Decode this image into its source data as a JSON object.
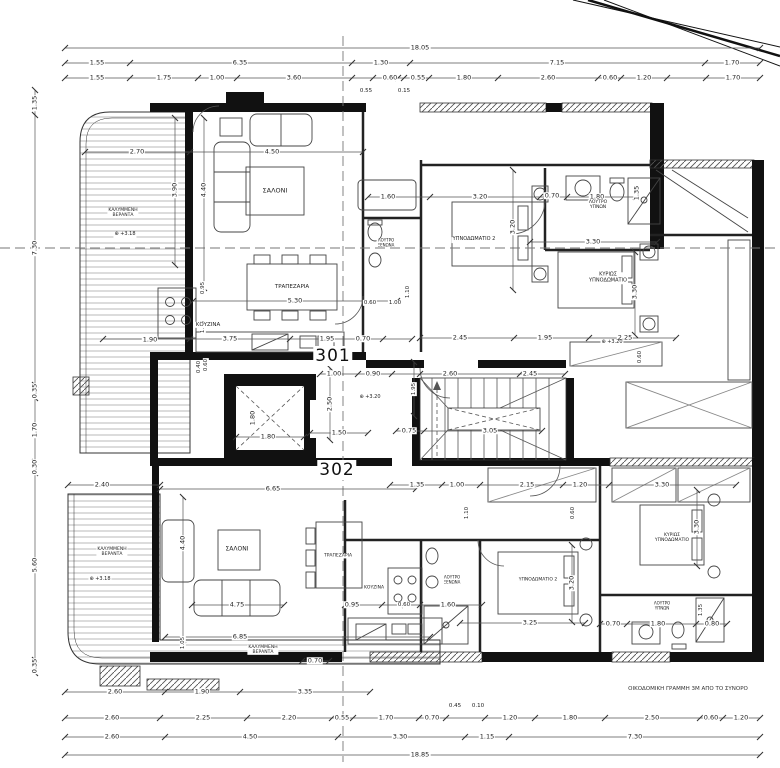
{
  "plan": {
    "apartments": [
      {
        "number": "301"
      },
      {
        "number": "302"
      }
    ],
    "note": "ΟΙΚΟΔΟΜΙΚΗ ΓΡΑΜΜΗ 3Μ ΑΠΟ ΤΟ ΣΥΝΟΡΟ",
    "overall_width_top": "18.05",
    "overall_width_bottom": "18.85",
    "levels": [
      "+3.20",
      "+3.18"
    ],
    "elevator_size": "1.80 x 1.80"
  },
  "labels": [
    {
      "name": "dim-label",
      "text": "18.05",
      "x": 420,
      "y": 48
    },
    {
      "name": "dim-label",
      "text": "1.55",
      "x": 97,
      "y": 63
    },
    {
      "name": "dim-label",
      "text": "6.35",
      "x": 240,
      "y": 63
    },
    {
      "name": "dim-label",
      "text": "1.30",
      "x": 381,
      "y": 63
    },
    {
      "name": "dim-label",
      "text": "7.15",
      "x": 557,
      "y": 63
    },
    {
      "name": "dim-label",
      "text": "1.70",
      "x": 732,
      "y": 63
    },
    {
      "name": "dim-label",
      "text": "1.55",
      "x": 97,
      "y": 78
    },
    {
      "name": "dim-label",
      "text": "1.75",
      "x": 164,
      "y": 78
    },
    {
      "name": "dim-label",
      "text": "1.00",
      "x": 217,
      "y": 78
    },
    {
      "name": "dim-label",
      "text": "3.60",
      "x": 294,
      "y": 78
    },
    {
      "name": "dim-label",
      "text": "0.60",
      "x": 390,
      "y": 78
    },
    {
      "name": "dim-label",
      "text": "0.55",
      "x": 418,
      "y": 78
    },
    {
      "name": "dim-label",
      "text": "1.80",
      "x": 464,
      "y": 78
    },
    {
      "name": "dim-label",
      "text": "2.60",
      "x": 548,
      "y": 78
    },
    {
      "name": "dim-label",
      "text": "0.60",
      "x": 610,
      "y": 78
    },
    {
      "name": "dim-label",
      "text": "1.20",
      "x": 644,
      "y": 78
    },
    {
      "name": "dim-label",
      "text": "1.70",
      "x": 733,
      "y": 78
    },
    {
      "name": "dim-label",
      "text": "0.55",
      "x": 366,
      "y": 91,
      "s": 5.5
    },
    {
      "name": "dim-label",
      "text": "0.15",
      "x": 404,
      "y": 91,
      "s": 5.5
    },
    {
      "name": "dim-label",
      "text": "1.35",
      "x": 35,
      "y": 103,
      "rot": true
    },
    {
      "name": "dim-label",
      "text": "7.30",
      "x": 35,
      "y": 248,
      "rot": true
    },
    {
      "name": "dim-label",
      "text": "0.35",
      "x": 35,
      "y": 391,
      "rot": true
    },
    {
      "name": "dim-label",
      "text": "1.70",
      "x": 35,
      "y": 430,
      "rot": true
    },
    {
      "name": "dim-label",
      "text": "0.30",
      "x": 35,
      "y": 467,
      "rot": true
    },
    {
      "name": "dim-label",
      "text": "5.60",
      "x": 35,
      "y": 565,
      "rot": true
    },
    {
      "name": "dim-label",
      "text": "0.35",
      "x": 35,
      "y": 666,
      "rot": true
    },
    {
      "name": "dim-label",
      "text": "2.60",
      "x": 115,
      "y": 692
    },
    {
      "name": "dim-label",
      "text": "1.90",
      "x": 202,
      "y": 692
    },
    {
      "name": "dim-label",
      "text": "3.35",
      "x": 305,
      "y": 692
    },
    {
      "name": "dim-label",
      "text": "2.60",
      "x": 112,
      "y": 718
    },
    {
      "name": "dim-label",
      "text": "2.25",
      "x": 203,
      "y": 718
    },
    {
      "name": "dim-label",
      "text": "2.20",
      "x": 289,
      "y": 718
    },
    {
      "name": "dim-label",
      "text": "0.55",
      "x": 342,
      "y": 718
    },
    {
      "name": "dim-label",
      "text": "1.70",
      "x": 386,
      "y": 718
    },
    {
      "name": "dim-label",
      "text": "0.70",
      "x": 432,
      "y": 718
    },
    {
      "name": "dim-label",
      "text": "0.45",
      "x": 455,
      "y": 706,
      "s": 5.5
    },
    {
      "name": "dim-label",
      "text": "0.10",
      "x": 478,
      "y": 706,
      "s": 5.5
    },
    {
      "name": "dim-label",
      "text": "1.20",
      "x": 510,
      "y": 718
    },
    {
      "name": "dim-label",
      "text": "1.80",
      "x": 570,
      "y": 718
    },
    {
      "name": "dim-label",
      "text": "2.50",
      "x": 652,
      "y": 718
    },
    {
      "name": "dim-label",
      "text": "0.60",
      "x": 711,
      "y": 718
    },
    {
      "name": "dim-label",
      "text": "1.20",
      "x": 741,
      "y": 718
    },
    {
      "name": "dim-label",
      "text": "2.60",
      "x": 112,
      "y": 737
    },
    {
      "name": "dim-label",
      "text": "4.50",
      "x": 250,
      "y": 737
    },
    {
      "name": "dim-label",
      "text": "3.30",
      "x": 400,
      "y": 737
    },
    {
      "name": "dim-label",
      "text": "1.15",
      "x": 487,
      "y": 737
    },
    {
      "name": "dim-label",
      "text": "7.30",
      "x": 635,
      "y": 737
    },
    {
      "name": "dim-label",
      "text": "18.85",
      "x": 420,
      "y": 755
    },
    {
      "name": "dim-label",
      "text": "2.70",
      "x": 137,
      "y": 152
    },
    {
      "name": "dim-label",
      "text": "4.50",
      "x": 272,
      "y": 152
    },
    {
      "name": "dim-label",
      "text": "3.90",
      "x": 175,
      "y": 190,
      "rot": true
    },
    {
      "name": "dim-label",
      "text": "4.40",
      "x": 204,
      "y": 190,
      "rot": true
    },
    {
      "name": "dim-label",
      "text": "1.90",
      "x": 150,
      "y": 340
    },
    {
      "name": "dim-label",
      "text": "3.75",
      "x": 230,
      "y": 339
    },
    {
      "name": "dim-label",
      "text": "1.95",
      "x": 327,
      "y": 339
    },
    {
      "name": "dim-label",
      "text": "0.70",
      "x": 363,
      "y": 339
    },
    {
      "name": "dim-label",
      "text": "0.95",
      "x": 203,
      "y": 288,
      "rot": true,
      "s": 5.5
    },
    {
      "name": "dim-label",
      "text": "1.35",
      "x": 203,
      "y": 327,
      "rot": true,
      "s": 5.5
    },
    {
      "name": "dim-label",
      "text": "0.60",
      "x": 206,
      "y": 365,
      "rot": true,
      "s": 5.5
    },
    {
      "name": "dim-label",
      "text": "5.30",
      "x": 295,
      "y": 301
    },
    {
      "name": "dim-label",
      "text": "1.00",
      "x": 334,
      "y": 374
    },
    {
      "name": "dim-label",
      "text": "0.90",
      "x": 373,
      "y": 374
    },
    {
      "name": "dim-label",
      "text": "2.60",
      "x": 450,
      "y": 374
    },
    {
      "name": "dim-label",
      "text": "2.45",
      "x": 530,
      "y": 374
    },
    {
      "name": "dim-label",
      "text": "1.60",
      "x": 388,
      "y": 197
    },
    {
      "name": "dim-label",
      "text": "3.20",
      "x": 480,
      "y": 197
    },
    {
      "name": "dim-label",
      "text": "0.70",
      "x": 552,
      "y": 196
    },
    {
      "name": "dim-label",
      "text": "1.80",
      "x": 597,
      "y": 197
    },
    {
      "name": "dim-label",
      "text": "1.35",
      "x": 637,
      "y": 193,
      "rot": true
    },
    {
      "name": "dim-label",
      "text": "3.20",
      "x": 513,
      "y": 227,
      "rot": true
    },
    {
      "name": "dim-label",
      "text": "1.10",
      "x": 408,
      "y": 292,
      "rot": true,
      "s": 5.5
    },
    {
      "name": "dim-label",
      "text": "0.60",
      "x": 370,
      "y": 303,
      "s": 5.5
    },
    {
      "name": "dim-label",
      "text": "1.00",
      "x": 395,
      "y": 303,
      "s": 5.5
    },
    {
      "name": "dim-label",
      "text": "3.30",
      "x": 593,
      "y": 242
    },
    {
      "name": "dim-label",
      "text": "3.30",
      "x": 635,
      "y": 292,
      "rot": true
    },
    {
      "name": "dim-label",
      "text": "2.45",
      "x": 460,
      "y": 338
    },
    {
      "name": "dim-label",
      "text": "1.95",
      "x": 545,
      "y": 338
    },
    {
      "name": "dim-label",
      "text": "2.25",
      "x": 625,
      "y": 338
    },
    {
      "name": "dim-label",
      "text": "0.60",
      "x": 640,
      "y": 357,
      "rot": true,
      "s": 5.5
    },
    {
      "name": "dim-label",
      "text": "0.40",
      "x": 199,
      "y": 367,
      "rot": true,
      "s": 5.5
    },
    {
      "name": "dim-label",
      "text": "1.80",
      "x": 253,
      "y": 418,
      "rot": true
    },
    {
      "name": "dim-label",
      "text": "1.80",
      "x": 268,
      "y": 437
    },
    {
      "name": "dim-label",
      "text": "2.50",
      "x": 330,
      "y": 404,
      "rot": true
    },
    {
      "name": "dim-label",
      "text": "1.50",
      "x": 339,
      "y": 433
    },
    {
      "name": "dim-label",
      "text": "1.95",
      "x": 414,
      "y": 389,
      "rot": true,
      "s": 5.5
    },
    {
      "name": "dim-label",
      "text": "0.75",
      "x": 409,
      "y": 431
    },
    {
      "name": "dim-label",
      "text": "3.05",
      "x": 490,
      "y": 431
    },
    {
      "name": "dim-label",
      "text": "2.40",
      "x": 102,
      "y": 485
    },
    {
      "name": "dim-label",
      "text": "6.65",
      "x": 273,
      "y": 489
    },
    {
      "name": "dim-label",
      "text": "1.35",
      "x": 417,
      "y": 485
    },
    {
      "name": "dim-label",
      "text": "1.00",
      "x": 457,
      "y": 485
    },
    {
      "name": "dim-label",
      "text": "2.15",
      "x": 527,
      "y": 485
    },
    {
      "name": "dim-label",
      "text": "1.20",
      "x": 580,
      "y": 485
    },
    {
      "name": "dim-label",
      "text": "3.30",
      "x": 662,
      "y": 485
    },
    {
      "name": "dim-label",
      "text": "1.10",
      "x": 467,
      "y": 513,
      "rot": true,
      "s": 5.5
    },
    {
      "name": "dim-label",
      "text": "0.60",
      "x": 573,
      "y": 513,
      "rot": true,
      "s": 5.5
    },
    {
      "name": "dim-label",
      "text": "4.40",
      "x": 183,
      "y": 543,
      "rot": true
    },
    {
      "name": "dim-label",
      "text": "4.75",
      "x": 237,
      "y": 605
    },
    {
      "name": "dim-label",
      "text": "6.85",
      "x": 240,
      "y": 637
    },
    {
      "name": "dim-label",
      "text": "1.05",
      "x": 183,
      "y": 643,
      "rot": true,
      "s": 5.5
    },
    {
      "name": "dim-label",
      "text": "0.70",
      "x": 315,
      "y": 661
    },
    {
      "name": "dim-label",
      "text": "0.95",
      "x": 352,
      "y": 605
    },
    {
      "name": "dim-label",
      "text": "0.60",
      "x": 404,
      "y": 605,
      "s": 5.5
    },
    {
      "name": "dim-label",
      "text": "1.60",
      "x": 448,
      "y": 605
    },
    {
      "name": "dim-label",
      "text": "3.20",
      "x": 572,
      "y": 583,
      "rot": true
    },
    {
      "name": "dim-label",
      "text": "3.25",
      "x": 530,
      "y": 623
    },
    {
      "name": "dim-label",
      "text": "3.30",
      "x": 697,
      "y": 527,
      "rot": true
    },
    {
      "name": "dim-label",
      "text": "0.70",
      "x": 613,
      "y": 624
    },
    {
      "name": "dim-label",
      "text": "1.80",
      "x": 658,
      "y": 624
    },
    {
      "name": "dim-label",
      "text": "0.80",
      "x": 712,
      "y": 624
    },
    {
      "name": "dim-label",
      "text": "1.35",
      "x": 701,
      "y": 610,
      "rot": true,
      "s": 5.5
    },
    {
      "name": "room-label-salon-301",
      "text": "ΣΑΛΟΝΙ",
      "x": 275,
      "y": 191,
      "s": 6.5
    },
    {
      "name": "room-label-trapezaria-301",
      "text": "ΤΡΑΠΕΖΑΡΙΑ",
      "x": 292,
      "y": 287,
      "s": 5.5
    },
    {
      "name": "room-label-kouzina-301",
      "text": "ΚΟΥΖΙΝΑ",
      "x": 208,
      "y": 325,
      "s": 5.5
    },
    {
      "name": "room-label-bedroom2-301",
      "text": "ΥΠΝΟΔΩΜΑΤΙΟ 2",
      "x": 474,
      "y": 240,
      "s": 5
    },
    {
      "name": "room-label-master-301",
      "text": "ΚΥΡΙΩΣ\nΥΠΝΟΔΩΜΑΤΙΟ",
      "x": 608,
      "y": 278,
      "s": 5
    },
    {
      "name": "room-label-bath-301",
      "text": "ΛΟΥΤΡΟ\nΥΠΝΩΝ",
      "x": 598,
      "y": 205,
      "s": 4.5
    },
    {
      "name": "room-label-wc-301",
      "text": "ΛΟΥΤΡΟ\nΞΕΝΩΝΑ",
      "x": 386,
      "y": 243,
      "s": 4
    },
    {
      "name": "room-label-veranda-301",
      "text": "ΚΑΛΥΜΜΕΝΗ\nΒΕΡΑΝΤΑ",
      "x": 123,
      "y": 213,
      "s": 4.5
    },
    {
      "name": "level-marker",
      "text": "⊕ +3.18",
      "x": 125,
      "y": 235,
      "s": 5
    },
    {
      "name": "room-label-salon-302",
      "text": "ΣΑΛΟΝΙ",
      "x": 237,
      "y": 550,
      "s": 6
    },
    {
      "name": "room-label-trapezaria-302",
      "text": "ΤΡΑΠΕΖΑΡΙΑ",
      "x": 338,
      "y": 556,
      "s": 4.5
    },
    {
      "name": "room-label-kouzina-302",
      "text": "ΚΟΥΖΙΝΑ",
      "x": 374,
      "y": 588,
      "s": 4.5
    },
    {
      "name": "room-label-bedroom2-302",
      "text": "ΥΠΝΟΔΩΜΑΤΙΟ 2",
      "x": 538,
      "y": 580,
      "s": 4.5
    },
    {
      "name": "room-label-master-302",
      "text": "ΚΥΡΙΩΣ\nΥΠΝΟΔΩΜΑΤΙΟ",
      "x": 672,
      "y": 538,
      "s": 4.5
    },
    {
      "name": "room-label-bath-302",
      "text": "ΛΟΥΤΡΟ\nΥΠΝΩΝ",
      "x": 662,
      "y": 606,
      "s": 4
    },
    {
      "name": "room-label-wc-302",
      "text": "ΛΟΥΤΡΟ\nΞΕΝΩΝΑ",
      "x": 452,
      "y": 580,
      "s": 4
    },
    {
      "name": "room-label-veranda-302",
      "text": "ΚΑΛΥΜΜΕΝΗ\nΒΕΡΑΝΤΑ",
      "x": 112,
      "y": 552,
      "s": 4.5
    },
    {
      "name": "level-marker",
      "text": "⊕ +3.18",
      "x": 100,
      "y": 580,
      "s": 5
    },
    {
      "name": "level-marker",
      "text": "⊕ +3.20",
      "x": 370,
      "y": 398,
      "s": 5
    },
    {
      "name": "level-marker",
      "text": "⊕ +3.20",
      "x": 612,
      "y": 343,
      "s": 5
    },
    {
      "name": "room-label-veranda-302b",
      "text": "ΚΑΛΥΜΜΕΝΗ\nΒΕΡΑΝΤΑ",
      "x": 263,
      "y": 650,
      "s": 4.5
    }
  ]
}
